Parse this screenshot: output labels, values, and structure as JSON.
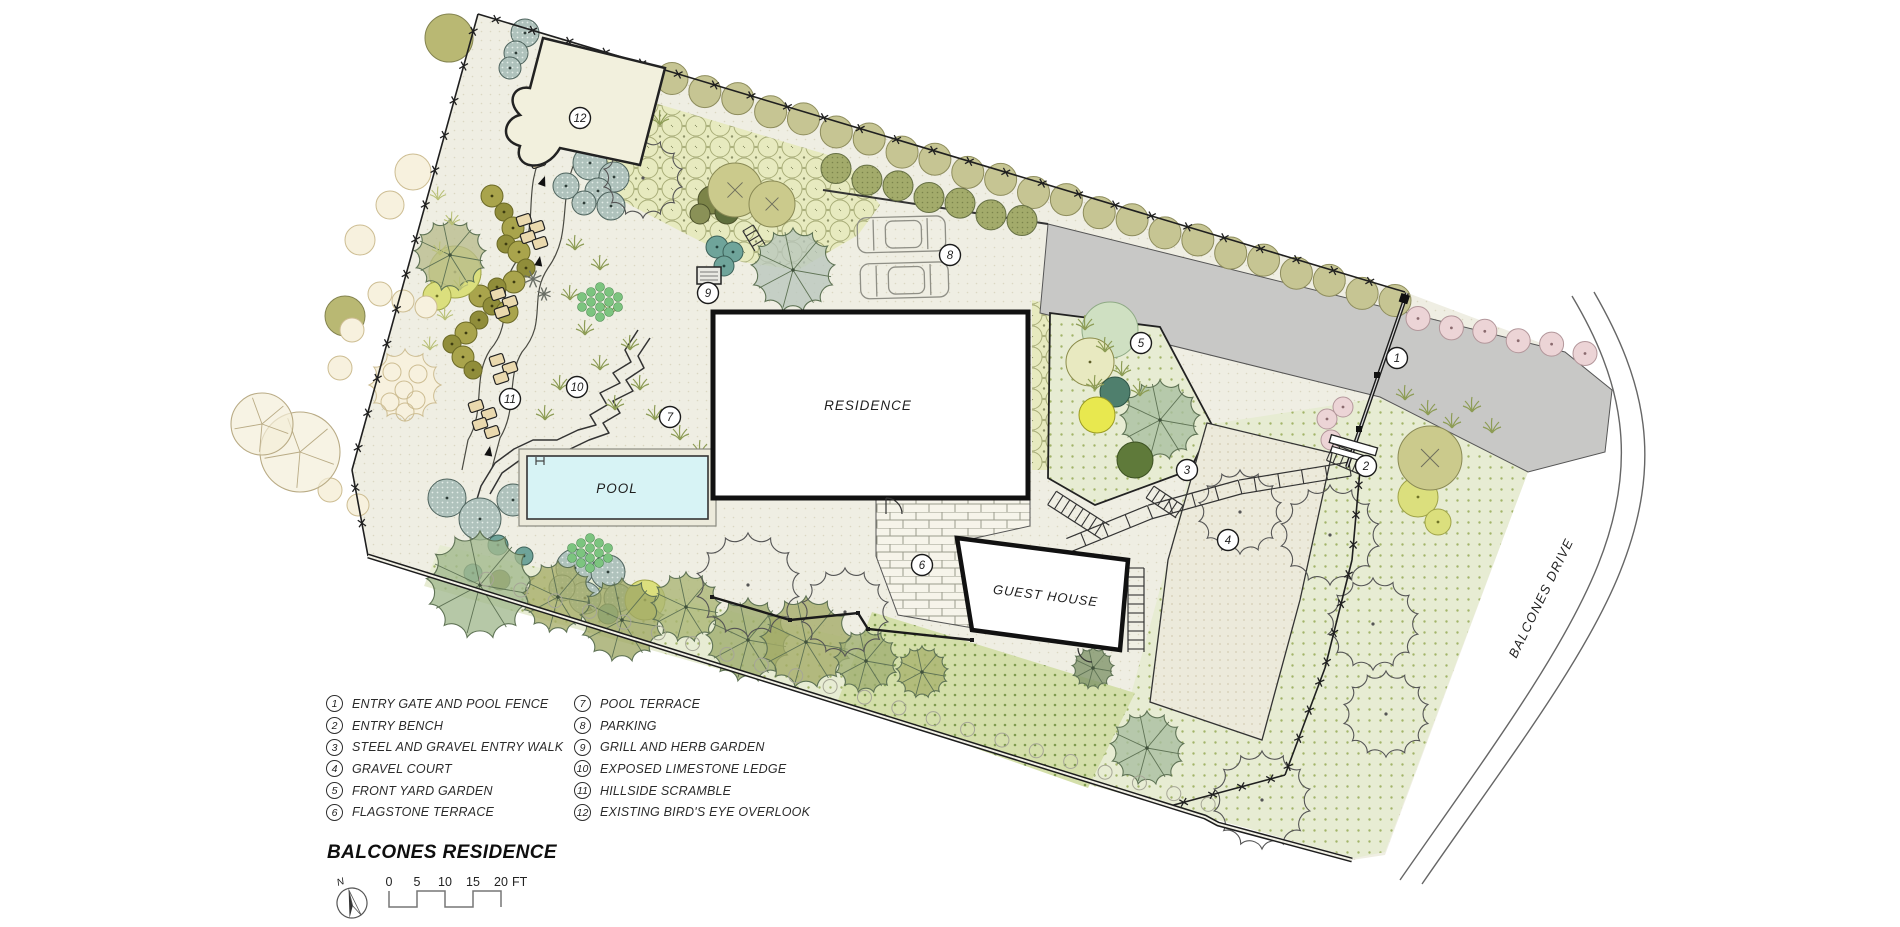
{
  "title_block": {
    "title": "BALCONES RESIDENCE",
    "north_label": "N",
    "scale_ticks": [
      "0",
      "5",
      "10",
      "15",
      "20"
    ],
    "scale_unit": "FT"
  },
  "plan_labels": {
    "residence": "RESIDENCE",
    "pool": "POOL",
    "guest_house": "GUEST HOUSE",
    "street": "BALCONES DRIVE"
  },
  "legend": {
    "items": [
      {
        "n": "1",
        "label": "ENTRY GATE AND POOL FENCE"
      },
      {
        "n": "2",
        "label": "ENTRY BENCH"
      },
      {
        "n": "3",
        "label": "STEEL AND GRAVEL ENTRY WALK"
      },
      {
        "n": "4",
        "label": "GRAVEL COURT"
      },
      {
        "n": "5",
        "label": "FRONT YARD GARDEN"
      },
      {
        "n": "6",
        "label": "FLAGSTONE TERRACE"
      },
      {
        "n": "7",
        "label": "POOL TERRACE"
      },
      {
        "n": "8",
        "label": "PARKING"
      },
      {
        "n": "9",
        "label": "GRILL AND HERB GARDEN"
      },
      {
        "n": "10",
        "label": "EXPOSED LIMESTONE LEDGE"
      },
      {
        "n": "11",
        "label": "HILLSIDE SCRAMBLE"
      },
      {
        "n": "12",
        "label": "EXISTING BIRD'S EYE OVERLOOK"
      }
    ]
  },
  "colors": {
    "ground": "#efeee3",
    "lawn": "#e7ecd3",
    "dense_planting": "#d4dfaa",
    "driveway": "#c8c8c6",
    "pool_water": "#d7f3f5",
    "canopy_green": "#a3ab66",
    "hedge_olive": "#c6c593",
    "flagstone": "#f6f4ea",
    "boundary": "#1d1d1d"
  }
}
